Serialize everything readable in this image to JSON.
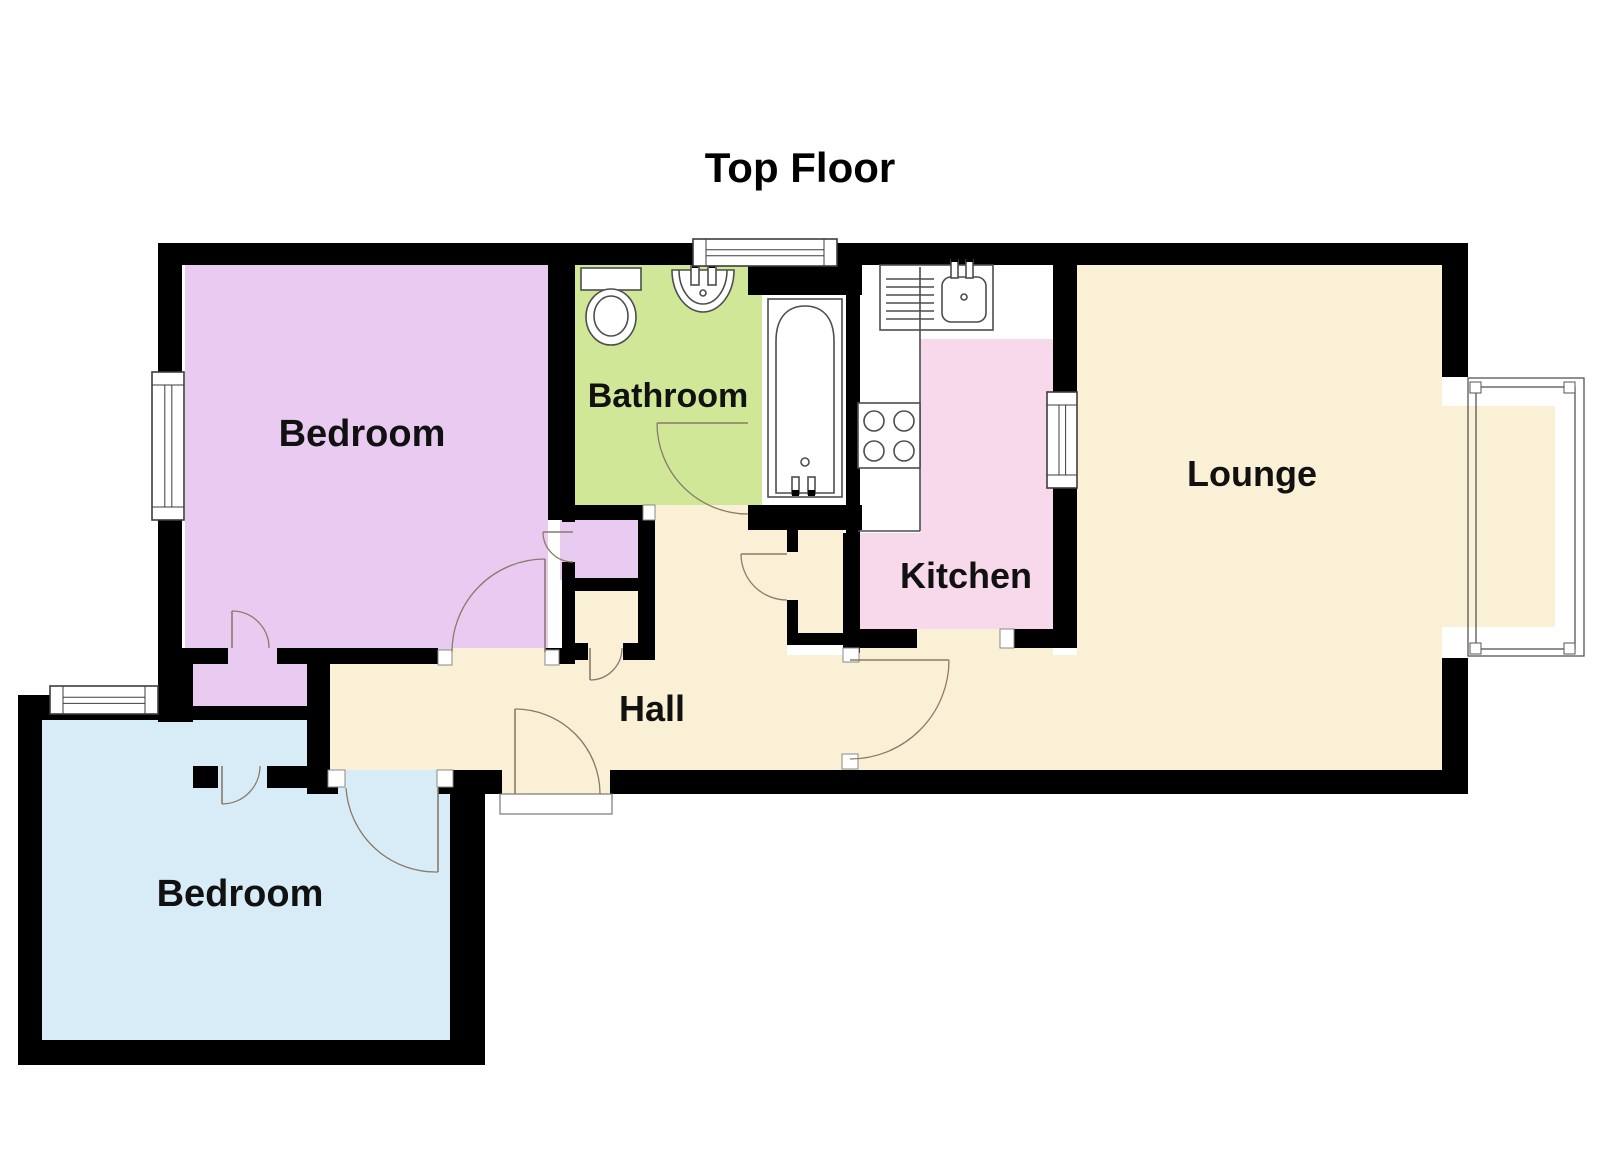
{
  "title": {
    "text": "Top Floor"
  },
  "canvas": {
    "width": 1600,
    "height": 1163
  },
  "colors": {
    "wall": "#000000",
    "purple": "#e9cbf2",
    "blue": "#d8ecf7",
    "green": "#cfe796",
    "pink": "#f8d9ec",
    "cream": "#faf0d6",
    "white": "#ffffff",
    "door": "#8a7a68",
    "fixture": "#4d4d4d",
    "frame": "#3d3d3d",
    "label": "#111111"
  },
  "rooms": [
    {
      "name": "bedroom-top",
      "label": "Bedroom",
      "x": 362,
      "y": 446,
      "size": 38
    },
    {
      "name": "bathroom",
      "label": "Bathroom",
      "x": 668,
      "y": 407,
      "size": 34
    },
    {
      "name": "kitchen",
      "label": "Kitchen",
      "x": 966,
      "y": 588,
      "size": 36
    },
    {
      "name": "lounge",
      "label": "Lounge",
      "x": 1252,
      "y": 486,
      "size": 36
    },
    {
      "name": "hall",
      "label": "Hall",
      "x": 652,
      "y": 721,
      "size": 36
    },
    {
      "name": "bedroom-bottom",
      "label": "Bedroom",
      "x": 240,
      "y": 906,
      "size": 38
    }
  ],
  "floor_plan": {
    "floors": [
      {
        "n": "bedroom-top-floor",
        "c": "purple",
        "x": 185,
        "y": 265,
        "w": 363,
        "h": 399
      },
      {
        "n": "bedroom-door-gap",
        "c": "cream",
        "x": 452,
        "y": 648,
        "w": 93,
        "h": 18
      },
      {
        "n": "closet-gap-top",
        "c": "purple",
        "x": 228,
        "y": 648,
        "w": 49,
        "h": 16
      },
      {
        "n": "closet-top-floor",
        "c": "purple",
        "x": 193,
        "y": 664,
        "w": 114,
        "h": 56
      },
      {
        "n": "cupboard-purple-floor",
        "c": "purple",
        "x": 560,
        "y": 517,
        "w": 78,
        "h": 63
      },
      {
        "n": "closet-bottom-floor",
        "c": "blue",
        "x": 197,
        "y": 720,
        "w": 110,
        "h": 46
      },
      {
        "n": "closet-gap-bottom",
        "c": "blue",
        "x": 218,
        "y": 766,
        "w": 49,
        "h": 22
      },
      {
        "n": "bedroom-bottom-floor",
        "c": "blue",
        "x": 42,
        "y": 713,
        "w": 411,
        "h": 330
      },
      {
        "n": "bedroom-bottom-door-gap",
        "c": "blue",
        "x": 338,
        "y": 770,
        "w": 100,
        "h": 26
      },
      {
        "n": "bathroom-floor",
        "c": "green",
        "x": 575,
        "y": 265,
        "w": 187,
        "h": 240
      },
      {
        "n": "bath-area-floor",
        "c": "white",
        "x": 762,
        "y": 293,
        "w": 86,
        "h": 212
      },
      {
        "n": "kitchen-floor",
        "c": "pink",
        "x": 858,
        "y": 265,
        "w": 195,
        "h": 365
      },
      {
        "n": "kitchen-counter-area",
        "c": "white",
        "x": 858,
        "y": 265,
        "w": 195,
        "h": 74
      },
      {
        "n": "kitchen-units-area",
        "c": "white",
        "x": 858,
        "y": 265,
        "w": 62,
        "h": 268
      },
      {
        "n": "kitchen-door-gap",
        "c": "cream",
        "x": 917,
        "y": 629,
        "w": 83,
        "h": 19
      },
      {
        "n": "lounge-floor",
        "c": "cream",
        "x": 1077,
        "y": 265,
        "w": 365,
        "h": 505
      },
      {
        "n": "hall-floor",
        "c": "cream",
        "x": 330,
        "y": 655,
        "w": 1112,
        "h": 115
      },
      {
        "n": "hall-pocket-floor",
        "c": "cream",
        "x": 655,
        "y": 505,
        "w": 132,
        "h": 150
      },
      {
        "n": "hall-kitchen-strip",
        "c": "cream",
        "x": 860,
        "y": 643,
        "w": 193,
        "h": 22
      },
      {
        "n": "cupboard-cream-floor",
        "c": "cream",
        "x": 575,
        "y": 591,
        "w": 63,
        "h": 52
      },
      {
        "n": "cupboard-cream-gap",
        "c": "cream",
        "x": 588,
        "y": 643,
        "w": 35,
        "h": 17
      },
      {
        "n": "hall-cupboard-floor",
        "c": "cream",
        "x": 798,
        "y": 528,
        "w": 45,
        "h": 105
      },
      {
        "n": "hall-cupboard-gap",
        "c": "cream",
        "x": 787,
        "y": 552,
        "w": 11,
        "h": 48
      },
      {
        "n": "entrance-gap",
        "c": "cream",
        "x": 502,
        "y": 770,
        "w": 108,
        "h": 26
      }
    ],
    "walls": [
      [
        158,
        243,
        1310,
        22
      ],
      [
        158,
        243,
        24,
        421
      ],
      [
        158,
        648,
        35,
        74
      ],
      [
        158,
        648,
        70,
        16
      ],
      [
        277,
        648,
        161,
        16
      ],
      [
        545,
        648,
        30,
        16
      ],
      [
        307,
        648,
        23,
        146
      ],
      [
        193,
        706,
        114,
        14
      ],
      [
        193,
        766,
        25,
        22
      ],
      [
        267,
        766,
        63,
        22
      ],
      [
        18,
        695,
        142,
        25
      ],
      [
        18,
        695,
        24,
        370
      ],
      [
        18,
        1040,
        467,
        25
      ],
      [
        450,
        770,
        35,
        295
      ],
      [
        307,
        770,
        31,
        24
      ],
      [
        438,
        770,
        64,
        24
      ],
      [
        610,
        770,
        858,
        24
      ],
      [
        548,
        265,
        27,
        240
      ],
      [
        562,
        505,
        13,
        17
      ],
      [
        562,
        562,
        13,
        102
      ],
      [
        562,
        578,
        76,
        13
      ],
      [
        548,
        505,
        95,
        15
      ],
      [
        638,
        505,
        17,
        155
      ],
      [
        562,
        643,
        26,
        17
      ],
      [
        623,
        643,
        32,
        17
      ],
      [
        748,
        265,
        114,
        30
      ],
      [
        846,
        293,
        14,
        240
      ],
      [
        843,
        533,
        17,
        120
      ],
      [
        748,
        505,
        114,
        25
      ],
      [
        787,
        528,
        11,
        24
      ],
      [
        787,
        600,
        11,
        33
      ],
      [
        787,
        633,
        56,
        12
      ],
      [
        843,
        629,
        74,
        19
      ],
      [
        1014,
        629,
        63,
        19
      ],
      [
        1053,
        265,
        24,
        378
      ],
      [
        1442,
        265,
        26,
        141
      ],
      [
        1442,
        628,
        26,
        166
      ]
    ],
    "jambs": [
      [
        438,
        650,
        14,
        15
      ],
      [
        545,
        650,
        14,
        15
      ],
      [
        643,
        505,
        12,
        15
      ],
      [
        843,
        648,
        16,
        14
      ],
      [
        842,
        754,
        16,
        15
      ],
      [
        1000,
        629,
        14,
        19
      ],
      [
        328,
        770,
        17,
        17
      ],
      [
        437,
        770,
        16,
        17
      ]
    ],
    "threshold": {
      "x": 500,
      "y": 794,
      "w": 112,
      "h": 20
    },
    "windows": [
      {
        "n": "bathroom-window",
        "x": 693,
        "y": 239,
        "w": 144,
        "h": 27,
        "o": "h"
      },
      {
        "n": "bedroom-top-window",
        "x": 152,
        "y": 372,
        "w": 32,
        "h": 148,
        "o": "v"
      },
      {
        "n": "bedroom-bottom-window",
        "x": 50,
        "y": 686,
        "w": 108,
        "h": 28,
        "o": "h"
      },
      {
        "n": "kitchen-hatch-window",
        "x": 1047,
        "y": 392,
        "w": 30,
        "h": 96,
        "o": "v"
      }
    ],
    "bay_window": {
      "n": "lounge-bay-window",
      "bg": [
        1442,
        377,
        146,
        281
      ],
      "floor": [
        1442,
        406,
        113,
        221
      ],
      "frames": [
        [
          1468,
          378,
          116,
          278
        ],
        [
          1476,
          387,
          99,
          262
        ]
      ],
      "pads": [
        [
          1470,
          382,
          11,
          11
        ],
        [
          1564,
          382,
          11,
          11
        ],
        [
          1470,
          643,
          11,
          11
        ],
        [
          1564,
          643,
          11,
          11
        ]
      ]
    },
    "doors": [
      {
        "n": "bathroom-door",
        "hx": 748,
        "hy": 423,
        "lx": 657,
        "ly": 423,
        "ax": 657,
        "ay": 423,
        "bx": 748,
        "by": 514,
        "r": 91,
        "sw": 0
      },
      {
        "n": "kitchen-door",
        "hx": 850,
        "hy": 660,
        "lx": 949,
        "ly": 660,
        "ax": 949,
        "ay": 660,
        "bx": 850,
        "by": 759,
        "r": 99,
        "sw": 1
      },
      {
        "n": "entrance-door",
        "hx": 515,
        "hy": 794,
        "lx": 515,
        "ly": 709,
        "ax": 515,
        "ay": 709,
        "bx": 600,
        "by": 794,
        "r": 85,
        "sw": 1
      },
      {
        "n": "bedroom-top-door",
        "hx": 545,
        "hy": 652,
        "lx": 545,
        "ly": 559,
        "ax": 545,
        "ay": 559,
        "bx": 452,
        "by": 652,
        "r": 93,
        "sw": 0
      },
      {
        "n": "bedroom-bottom-door",
        "hx": 438,
        "hy": 788,
        "lx": 438,
        "ly": 872,
        "ax": 346,
        "ay": 788,
        "bx": 438,
        "by": 872,
        "r": 90,
        "sw": 0
      },
      {
        "n": "closet-top-door",
        "hx": 232,
        "hy": 648,
        "lx": 232,
        "ly": 611,
        "ax": 232,
        "ay": 611,
        "bx": 269,
        "by": 648,
        "r": 37,
        "sw": 1
      },
      {
        "n": "closet-bottom-door",
        "hx": 222,
        "hy": 766,
        "lx": 222,
        "ly": 804,
        "ax": 222,
        "ay": 804,
        "bx": 260,
        "by": 766,
        "r": 38,
        "sw": 0
      },
      {
        "n": "cupboard-purple-door",
        "hx": 573,
        "hy": 532,
        "lx": 543,
        "ly": 532,
        "ax": 543,
        "ay": 532,
        "bx": 573,
        "by": 562,
        "r": 30,
        "sw": 0
      },
      {
        "n": "cupboard-cream-door",
        "hx": 590,
        "hy": 648,
        "lx": 590,
        "ly": 680,
        "ax": 590,
        "ay": 680,
        "bx": 622,
        "by": 648,
        "r": 32,
        "sw": 0
      },
      {
        "n": "hall-cupboard-door",
        "hx": 787,
        "hy": 554,
        "lx": 741,
        "ly": 554,
        "ax": 741,
        "ay": 554,
        "bx": 787,
        "by": 600,
        "r": 46,
        "sw": 0
      }
    ],
    "fixtures": [
      {
        "t": "rect",
        "n": "toilet-cistern",
        "a": {
          "x": 581,
          "y": 268,
          "width": 60,
          "height": 22,
          "fill": "#ffffff"
        }
      },
      {
        "t": "ellipse",
        "n": "toilet-bowl",
        "a": {
          "cx": 611,
          "cy": 317,
          "rx": 25,
          "ry": 28,
          "fill": "#ffffff"
        }
      },
      {
        "t": "ellipse",
        "n": "toilet-bowl-inner",
        "a": {
          "cx": 611,
          "cy": 316,
          "rx": 17,
          "ry": 20,
          "fill": "none"
        }
      },
      {
        "t": "path",
        "n": "bathroom-sink",
        "a": {
          "d": "M672,270 a31,42 0 0 0 62,0 Z",
          "fill": "#ffffff"
        }
      },
      {
        "t": "path",
        "n": "bathroom-sink-inner",
        "a": {
          "d": "M679,270 a24,34 0 0 0 48,0",
          "fill": "none"
        }
      },
      {
        "t": "rect",
        "n": "sink-tap",
        "a": {
          "x": 691,
          "y": 266,
          "width": 8,
          "height": 19,
          "fill": "#ffffff"
        }
      },
      {
        "t": "rect",
        "n": "sink-tap",
        "a": {
          "x": 708,
          "y": 266,
          "width": 8,
          "height": 19,
          "fill": "#ffffff"
        }
      },
      {
        "t": "rect",
        "n": "sink-tap-tip",
        "a": {
          "x": 692,
          "y": 262,
          "width": 6,
          "height": 6,
          "fill": "#000000",
          "stroke": "none"
        }
      },
      {
        "t": "rect",
        "n": "sink-tap-tip",
        "a": {
          "x": 709,
          "y": 262,
          "width": 6,
          "height": 6,
          "fill": "#000000",
          "stroke": "none"
        }
      },
      {
        "t": "circle",
        "n": "sink-drain",
        "a": {
          "cx": 703,
          "cy": 293,
          "r": 3,
          "fill": "none"
        }
      },
      {
        "t": "rect",
        "n": "bathtub",
        "a": {
          "x": 768,
          "y": 299,
          "width": 74,
          "height": 198,
          "fill": "#ffffff"
        }
      },
      {
        "t": "path",
        "n": "bathtub-inner",
        "a": {
          "d": "M776,493 L776,341 C776,316 789,306 805,306 C821,306 834,316 834,341 L834,493 Z",
          "fill": "none"
        }
      },
      {
        "t": "circle",
        "n": "bathtub-drain",
        "a": {
          "cx": 805,
          "cy": 462,
          "r": 4,
          "fill": "none"
        }
      },
      {
        "t": "rect",
        "n": "bath-tap",
        "a": {
          "x": 792,
          "y": 477,
          "width": 7,
          "height": 17,
          "fill": "#ffffff"
        }
      },
      {
        "t": "rect",
        "n": "bath-tap",
        "a": {
          "x": 808,
          "y": 477,
          "width": 7,
          "height": 17,
          "fill": "#ffffff"
        }
      },
      {
        "t": "rect",
        "n": "bath-tap-tip",
        "a": {
          "x": 792,
          "y": 490,
          "width": 7,
          "height": 6,
          "fill": "#000000",
          "stroke": "none"
        }
      },
      {
        "t": "rect",
        "n": "bath-tap-tip",
        "a": {
          "x": 808,
          "y": 490,
          "width": 7,
          "height": 6,
          "fill": "#000000",
          "stroke": "none"
        }
      },
      {
        "t": "rect",
        "n": "kitchen-counter",
        "a": {
          "x": 880,
          "y": 265,
          "width": 113,
          "height": 65,
          "fill": "none"
        }
      },
      {
        "t": "line",
        "n": "drainer-line",
        "a": {
          "x1": 886,
          "y1": 279,
          "x2": 934,
          "y2": 279
        }
      },
      {
        "t": "line",
        "n": "drainer-line",
        "a": {
          "x1": 886,
          "y1": 287,
          "x2": 934,
          "y2": 287
        }
      },
      {
        "t": "line",
        "n": "drainer-line",
        "a": {
          "x1": 886,
          "y1": 295,
          "x2": 934,
          "y2": 295
        }
      },
      {
        "t": "line",
        "n": "drainer-line",
        "a": {
          "x1": 886,
          "y1": 303,
          "x2": 934,
          "y2": 303
        }
      },
      {
        "t": "line",
        "n": "drainer-line",
        "a": {
          "x1": 886,
          "y1": 311,
          "x2": 934,
          "y2": 311
        }
      },
      {
        "t": "line",
        "n": "drainer-line",
        "a": {
          "x1": 886,
          "y1": 319,
          "x2": 934,
          "y2": 319
        }
      },
      {
        "t": "rect",
        "n": "kitchen-sink",
        "a": {
          "x": 942,
          "y": 277,
          "width": 44,
          "height": 45,
          "rx": 9,
          "fill": "#ffffff"
        }
      },
      {
        "t": "rect",
        "n": "kitchen-tap",
        "a": {
          "x": 951,
          "y": 260,
          "width": 7,
          "height": 18,
          "fill": "#ffffff"
        }
      },
      {
        "t": "rect",
        "n": "kitchen-tap",
        "a": {
          "x": 966,
          "y": 260,
          "width": 7,
          "height": 18,
          "fill": "#ffffff"
        }
      },
      {
        "t": "rect",
        "n": "kitchen-tap-tip",
        "a": {
          "x": 951,
          "y": 257,
          "width": 7,
          "height": 5,
          "fill": "#000000",
          "stroke": "none"
        }
      },
      {
        "t": "rect",
        "n": "kitchen-tap-tip",
        "a": {
          "x": 966,
          "y": 257,
          "width": 7,
          "height": 5,
          "fill": "#000000",
          "stroke": "none"
        }
      },
      {
        "t": "circle",
        "n": "kitchen-sink-drain",
        "a": {
          "cx": 964,
          "cy": 297,
          "r": 3,
          "fill": "none"
        }
      },
      {
        "t": "line",
        "n": "unit-edge",
        "a": {
          "x1": 920,
          "y1": 267,
          "x2": 920,
          "y2": 531
        }
      },
      {
        "t": "line",
        "n": "unit-edge",
        "a": {
          "x1": 858,
          "y1": 531,
          "x2": 920,
          "y2": 531
        }
      },
      {
        "t": "rect",
        "n": "stove",
        "a": {
          "x": 858,
          "y": 403,
          "width": 62,
          "height": 65,
          "fill": "#ffffff"
        }
      },
      {
        "t": "circle",
        "n": "stove-burner",
        "a": {
          "cx": 874,
          "cy": 421,
          "r": 10,
          "fill": "none"
        }
      },
      {
        "t": "circle",
        "n": "stove-burner",
        "a": {
          "cx": 904,
          "cy": 421,
          "r": 10,
          "fill": "none"
        }
      },
      {
        "t": "circle",
        "n": "stove-burner",
        "a": {
          "cx": 874,
          "cy": 451,
          "r": 10,
          "fill": "none"
        }
      },
      {
        "t": "circle",
        "n": "stove-burner",
        "a": {
          "cx": 904,
          "cy": 451,
          "r": 10,
          "fill": "none"
        }
      }
    ]
  }
}
